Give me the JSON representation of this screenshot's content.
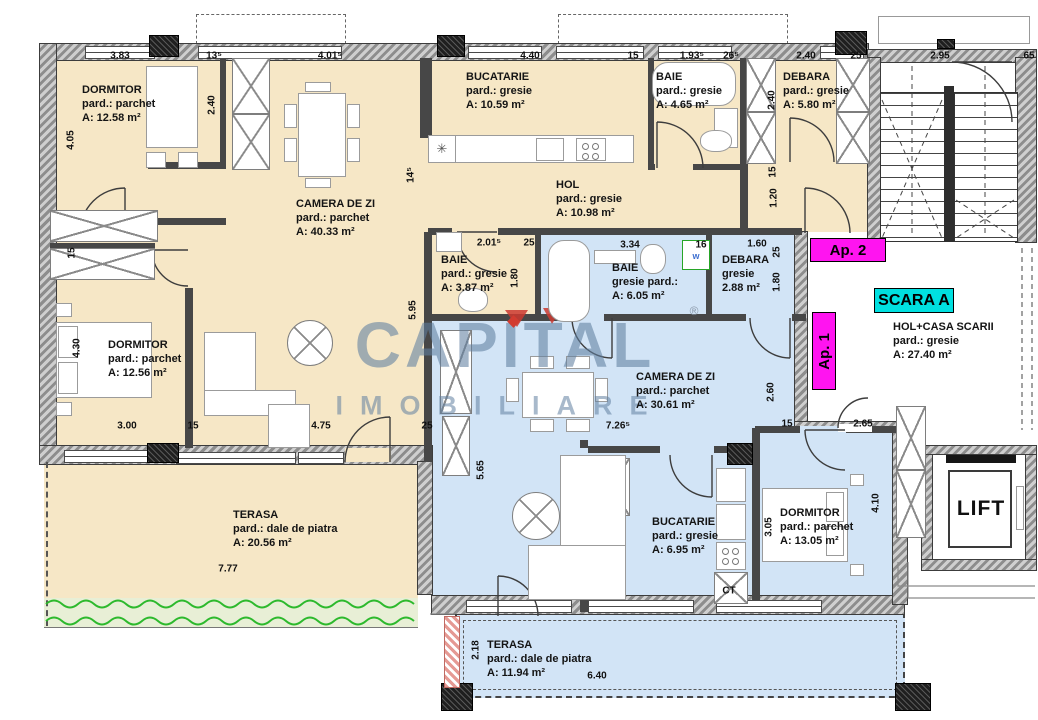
{
  "plan_title": "Etaj - Scara A",
  "colors": {
    "apartment2_fill": "#f6e7c6",
    "apartment1_fill": "#d2e4f6",
    "wall": "#474747",
    "grass_green": "#2db92d",
    "grass_band": "#e8efd6",
    "tag_magenta": "#ff14f0",
    "tag_cyan": "#00e0e0",
    "watermark_blue": "#60809f"
  },
  "watermark": {
    "line1": "CAPITAL",
    "line2": "IMOBILIARE"
  },
  "tags": {
    "ap1": "Ap. 1",
    "ap2": "Ap. 2",
    "scara": "SCARA A",
    "lift": "LIFT",
    "ct": "CT",
    "washer1": "w",
    "washer2": "w",
    "registered": "®"
  },
  "rooms": [
    {
      "id": "dormitor-1",
      "x": 82,
      "y": 83,
      "lines": [
        "DORMITOR",
        "pard.: parchet",
        "A: 12.58 m²"
      ]
    },
    {
      "id": "bucatarie-1",
      "x": 466,
      "y": 70,
      "lines": [
        "BUCATARIE",
        "pard.: gresie",
        "A: 10.59 m²"
      ]
    },
    {
      "id": "baie-465",
      "x": 656,
      "y": 70,
      "lines": [
        "BAIE",
        "pard.: gresie",
        "A: 4.65 m²"
      ]
    },
    {
      "id": "debara-580",
      "x": 783,
      "y": 70,
      "lines": [
        "DEBARA",
        "pard.: gresie",
        "A: 5.80 m²"
      ]
    },
    {
      "id": "camera-de-zi-4033",
      "x": 296,
      "y": 197,
      "lines": [
        "CAMERA DE ZI",
        "pard.: parchet",
        "A: 40.33 m²"
      ]
    },
    {
      "id": "hol",
      "x": 556,
      "y": 178,
      "lines": [
        "HOL",
        "pard.: gresie",
        "A: 10.98 m²"
      ]
    },
    {
      "id": "baie-387",
      "x": 441,
      "y": 253,
      "lines": [
        "BAIE",
        "pard.: gresie",
        "A: 3.87 m²"
      ]
    },
    {
      "id": "baie-605",
      "x": 612,
      "y": 261,
      "lines": [
        "BAIE",
        "gresie pard.:",
        "A: 6.05 m²"
      ]
    },
    {
      "id": "debara-288",
      "x": 722,
      "y": 253,
      "lines": [
        "DEBARA",
        "gresie",
        "2.88 m²"
      ]
    },
    {
      "id": "dormitor-2",
      "x": 108,
      "y": 338,
      "lines": [
        "DORMITOR",
        "pard.: parchet",
        "A: 12.56 m²"
      ]
    },
    {
      "id": "hol-casa-scarii",
      "x": 893,
      "y": 320,
      "lines": [
        "HOL+CASA SCARII",
        "pard.: gresie",
        "A: 27.40 m²"
      ]
    },
    {
      "id": "camera-de-zi-3061",
      "x": 636,
      "y": 370,
      "lines": [
        "CAMERA DE ZI",
        "pard.: parchet",
        "A: 30.61 m²"
      ]
    },
    {
      "id": "terasa-2056",
      "x": 233,
      "y": 508,
      "lines": [
        "TERASA",
        "pard.: dale de piatra",
        "A: 20.56 m²"
      ]
    },
    {
      "id": "bucatarie-2",
      "x": 652,
      "y": 515,
      "lines": [
        "BUCATARIE",
        "pard.: gresie",
        "A: 6.95 m²"
      ]
    },
    {
      "id": "dormitor-3",
      "x": 780,
      "y": 506,
      "lines": [
        "DORMITOR",
        "pard.: parchet",
        "A: 13.05 m²"
      ]
    },
    {
      "id": "terasa-1194",
      "x": 487,
      "y": 638,
      "lines": [
        "TERASA",
        "pard.: dale de piatra",
        "A: 11.94 m²"
      ]
    }
  ],
  "dimensions": [
    {
      "t": "3.83",
      "x": 120,
      "y": 56
    },
    {
      "t": "13⁵",
      "x": 214,
      "y": 56
    },
    {
      "t": "4.01⁵",
      "x": 330,
      "y": 56
    },
    {
      "t": "4.40",
      "x": 530,
      "y": 56
    },
    {
      "t": "15",
      "x": 633,
      "y": 56
    },
    {
      "t": "1.93⁵",
      "x": 692,
      "y": 56
    },
    {
      "t": "26⁵",
      "x": 731,
      "y": 56
    },
    {
      "t": "2.40",
      "x": 806,
      "y": 56
    },
    {
      "t": "25",
      "x": 856,
      "y": 56
    },
    {
      "t": "2.95",
      "x": 940,
      "y": 56
    },
    {
      "t": "65",
      "x": 1029,
      "y": 56
    },
    {
      "t": "4.05",
      "x": 71,
      "y": 140,
      "v": 1
    },
    {
      "t": "2.40",
      "x": 212,
      "y": 105,
      "v": 1
    },
    {
      "t": "15",
      "x": 72,
      "y": 253,
      "v": 1
    },
    {
      "t": "4.30",
      "x": 77,
      "y": 348,
      "v": 1
    },
    {
      "t": "14⁵",
      "x": 411,
      "y": 175,
      "v": 1
    },
    {
      "t": "5.95",
      "x": 413,
      "y": 310,
      "v": 1
    },
    {
      "t": "1.80",
      "x": 515,
      "y": 278,
      "v": 1
    },
    {
      "t": "2.40",
      "x": 772,
      "y": 100,
      "v": 1
    },
    {
      "t": "15",
      "x": 773,
      "y": 172,
      "v": 1
    },
    {
      "t": "1.20",
      "x": 774,
      "y": 198,
      "v": 1
    },
    {
      "t": "25",
      "x": 777,
      "y": 252,
      "v": 1
    },
    {
      "t": "1.80",
      "x": 777,
      "y": 282,
      "v": 1
    },
    {
      "t": "2.60",
      "x": 771,
      "y": 392,
      "v": 1
    },
    {
      "t": "5.65",
      "x": 481,
      "y": 470,
      "v": 1
    },
    {
      "t": "4.10",
      "x": 876,
      "y": 503,
      "v": 1
    },
    {
      "t": "3.05",
      "x": 769,
      "y": 527,
      "v": 1
    },
    {
      "t": "2.18",
      "x": 476,
      "y": 650,
      "v": 1
    },
    {
      "t": "2.01⁵",
      "x": 489,
      "y": 243
    },
    {
      "t": "25",
      "x": 529,
      "y": 243
    },
    {
      "t": "3.34",
      "x": 630,
      "y": 245
    },
    {
      "t": "16",
      "x": 701,
      "y": 245
    },
    {
      "t": "1.60",
      "x": 757,
      "y": 244
    },
    {
      "t": "3.00",
      "x": 127,
      "y": 426
    },
    {
      "t": "15",
      "x": 193,
      "y": 426
    },
    {
      "t": "4.75",
      "x": 321,
      "y": 426
    },
    {
      "t": "25",
      "x": 427,
      "y": 426
    },
    {
      "t": "7.26⁵",
      "x": 618,
      "y": 426
    },
    {
      "t": "15",
      "x": 787,
      "y": 424
    },
    {
      "t": "2.65",
      "x": 863,
      "y": 424
    },
    {
      "t": "7.77",
      "x": 228,
      "y": 569
    },
    {
      "t": "6.40",
      "x": 597,
      "y": 676
    }
  ]
}
